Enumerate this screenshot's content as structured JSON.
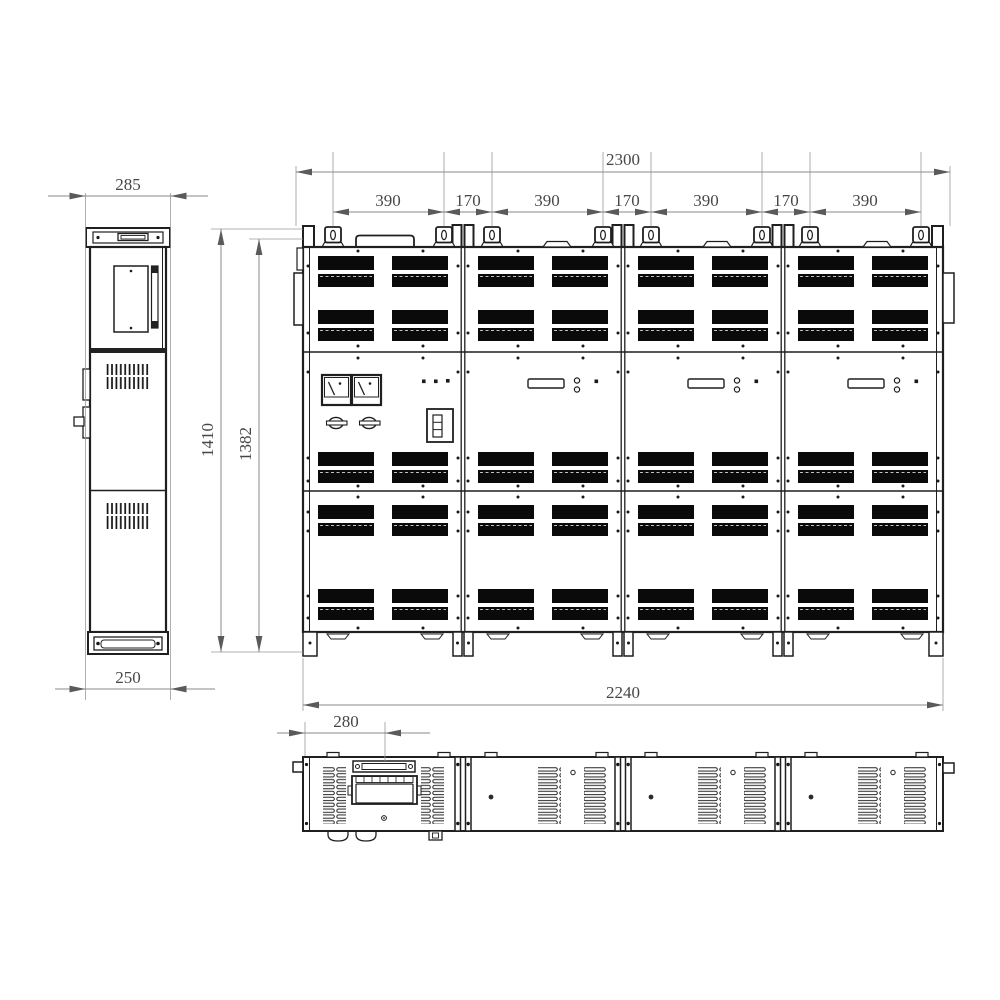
{
  "drawing": {
    "description": "Three-view dimensioned engineering drawing of a four-bay electrical cabinet lineup",
    "colors": {
      "background": "#ffffff",
      "line": "#1f1f1f",
      "dimension_line": "#8a8a8a",
      "dimension_text": "#474747",
      "vent_fill": "#0a0a0a"
    },
    "dims": {
      "side_top_width": "285",
      "side_bottom_width": "250",
      "height_total": "1410",
      "height_front": "1382",
      "front_width": "2300",
      "base_width": "2240",
      "top_offset": "280",
      "chain": [
        "390",
        "170",
        "390",
        "170",
        "390",
        "170",
        "390"
      ]
    }
  }
}
